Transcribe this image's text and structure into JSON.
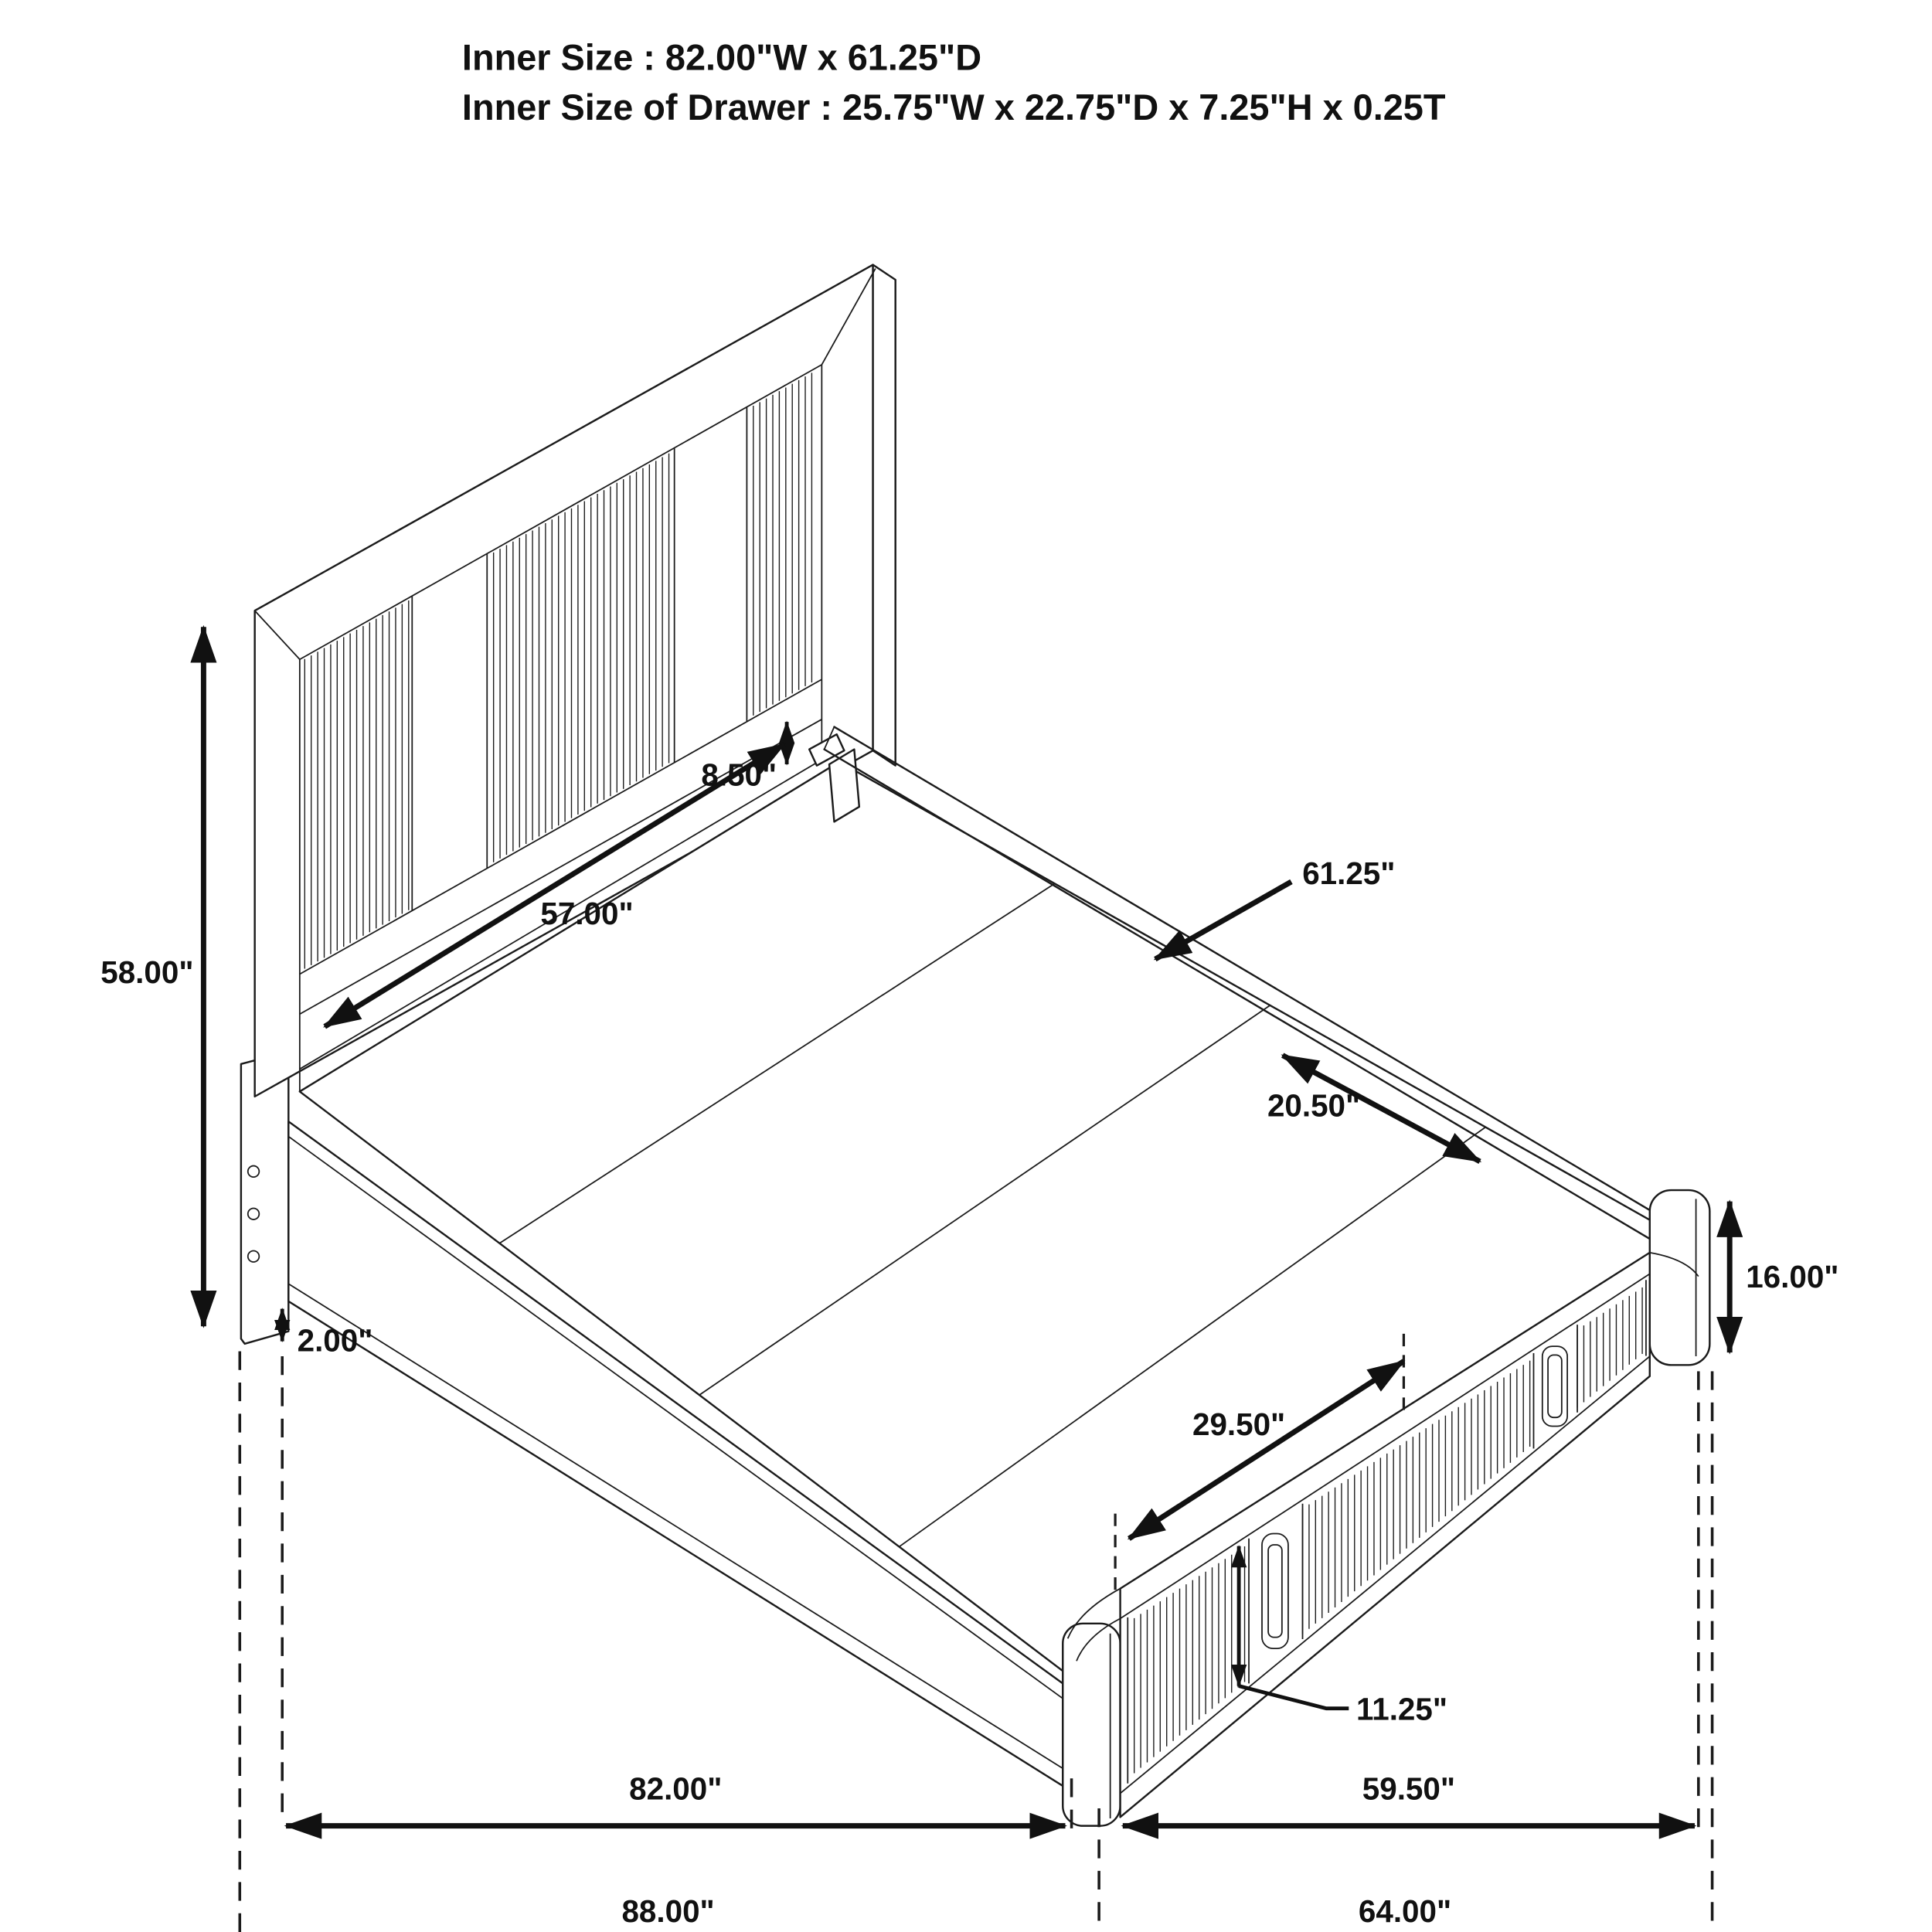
{
  "title": {
    "line1": "Inner Size : 82.00\"W x 61.25\"D",
    "line2": "Inner Size of Drawer : 25.75\"W x 22.75\"D x 7.25\"H x 0.25T"
  },
  "dimensions": {
    "headboard_height": "58.00\"",
    "headboard_opening_height": "8.50\"",
    "headboard_inner_width": "57.00\"",
    "platform_depth": "61.25\"",
    "side_rail_segment": "20.50\"",
    "floor_clearance": "2.00\"",
    "footboard_height": "16.00\"",
    "drawer_front_width": "29.50\"",
    "drawer_front_height": "11.25\"",
    "inner_width": "82.00\"",
    "footboard_side_depth": "59.50\"",
    "overall_width": "88.00\"",
    "overall_depth": "64.00\""
  },
  "diagram": {
    "subject": "storage platform bed with slatted headboard and footboard drawers",
    "style": "isometric technical line drawing",
    "line_color": "#1b1b1b",
    "background_color": "#ffffff"
  }
}
